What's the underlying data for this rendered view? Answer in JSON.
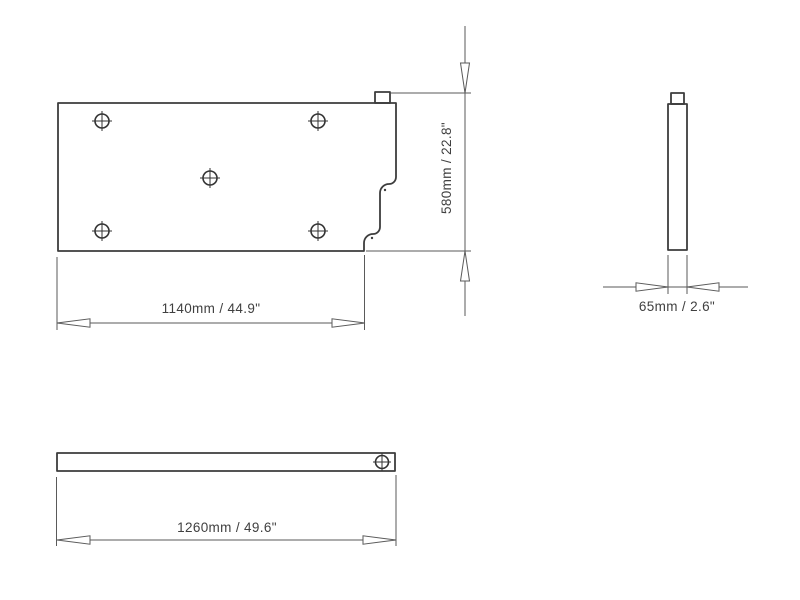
{
  "drawing": {
    "colors": {
      "background": "#ffffff",
      "outline": "#3d3d3d",
      "dimension_lines": "#5a5a5a",
      "text": "#404040"
    },
    "views": {
      "plan": {
        "width_dim": "1140mm / 44.9\"",
        "height_dim": "580mm / 22.8\"",
        "hole_count": 5
      },
      "side": {
        "width_dim": "65mm / 2.6\""
      },
      "front": {
        "width_dim": "1260mm / 49.6\"",
        "hole_count": 1
      }
    }
  }
}
